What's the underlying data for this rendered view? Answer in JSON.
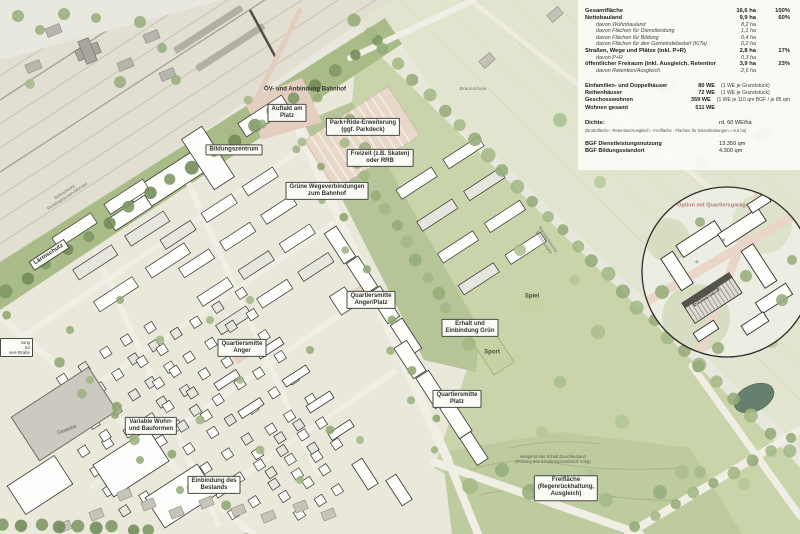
{
  "map": {
    "labels": {
      "station_link": "ÖV- und Anbindung Bahnhof",
      "auftakt": "Auftakt am\nPlatz",
      "park_ride": "Park+Ride-Erweiterung\n(ggf. Parkdeck)",
      "bildungszentrum": "Bildungszentrum",
      "freizeit": "Freizeit (z.B. Skaten)\noder RRB",
      "gruene_wege": "Grüne Wegeverbindungen\nzum Bahnhof",
      "laermschutz": "Lärmschutz",
      "bahnstrecke": "Bahnstrecke\nRecklinghausen-Münster",
      "qm_anger_platz": "Quartiersmitte\nAnger/Platz",
      "spiel": "Spiel",
      "erhalt_gruen": "Erhalt und\nEinbindung Grün",
      "sport": "Sport",
      "qm_anger": "Quartiersmitte\nAnger",
      "qm_platz": "Quartiersmitte\nPlatz",
      "variable_wohnformen": "Variable Wohn-\nund Bauformen",
      "gewerbe": "Gewerbe",
      "einbindung_bestand": "Einbindung des\nBestands",
      "freiflaeche": "Freifläche\n(Regenrückhaltung,\nAusgleich)",
      "baumbestand_note": "weitgehender Erhalt Baumbestand\n(Prüfung des Erhaltungszustands nötig)",
      "option_quartiersgarage": "Option mit Quartiersgarage",
      "quartiersgarage": "Quartiersgarage",
      "braunschule": "Braunschule",
      "bahntechnik": "Bahntechnische\nEinrichtungen",
      "strasse_fragment": "zung\ntur\nsen-Straße"
    },
    "storeys": [
      "IV",
      "III"
    ]
  },
  "legend": {
    "area_table": [
      {
        "label": "Gesamtfläche",
        "value": "16,6 ha",
        "pct": "100%",
        "style": "main"
      },
      {
        "label": "Nettobauland",
        "value": "9,9 ha",
        "pct": "60%",
        "style": "main"
      },
      {
        "label": "davon Wohnbauland",
        "value": "8,2 ha",
        "pct": "",
        "style": "sub"
      },
      {
        "label": "davon Flächen für Dienstleistung",
        "value": "1,1 ha",
        "pct": "",
        "style": "sub"
      },
      {
        "label": "davon Flächen für Bildung",
        "value": "0,4 ha",
        "pct": "",
        "style": "sub"
      },
      {
        "label": "davon Flächen für den Gemeindebedarf (KiTa)",
        "value": "0,2 ha",
        "pct": "",
        "style": "sub"
      },
      {
        "label": "Straßen, Wege und Plätze (inkl. P+R)",
        "value": "2,8 ha",
        "pct": "17%",
        "style": "main"
      },
      {
        "label": "davon P+R",
        "value": "0,3 ha",
        "pct": "",
        "style": "sub"
      },
      {
        "label": "öffentlicher Freiraum (inkl. Ausgleich, Retention,Lärmschutz)",
        "value": "3,9 ha",
        "pct": "23%",
        "style": "main"
      },
      {
        "label": "davon Retention/Ausgleich",
        "value": "2,6 ha",
        "pct": "",
        "style": "sub"
      }
    ],
    "housing_table": [
      {
        "label": "Einfamilien- und Doppelhäuser",
        "value": "80 WE",
        "note": "(1 WE je Grundstück)"
      },
      {
        "label": "Reihenhäuser",
        "value": "72 WE",
        "note": "(1 WE je Grundstück)"
      },
      {
        "label": "Geschosswohnen",
        "value": "359 WE",
        "note": "(1 WE je 110 qm BGF / je 85 qm"
      },
      {
        "label": "Wohnen gesamt",
        "value": "511 WE",
        "note": ""
      }
    ],
    "density": {
      "label": "Dichte:",
      "value": "rd. 60 WE/ha",
      "footnote": "(Bruttofläche - Retention/Ausgleich - Freifläche - Flächen für Dienstleistungen = 8,5 ha)"
    },
    "bgf_table": [
      {
        "label": "BGF Dienstleistungsnutzung",
        "value": "13.350 qm"
      },
      {
        "label": "BGF Bildungsstandort",
        "value": "4.300 qm"
      }
    ]
  },
  "colors": {
    "paper": "#e9e8df",
    "green_corridor": "#b5c597",
    "green_field": "#c9d4ab",
    "plaza_salmon": "#e3cec0",
    "building": "#fdfdfb",
    "outline": "#35352f"
  }
}
